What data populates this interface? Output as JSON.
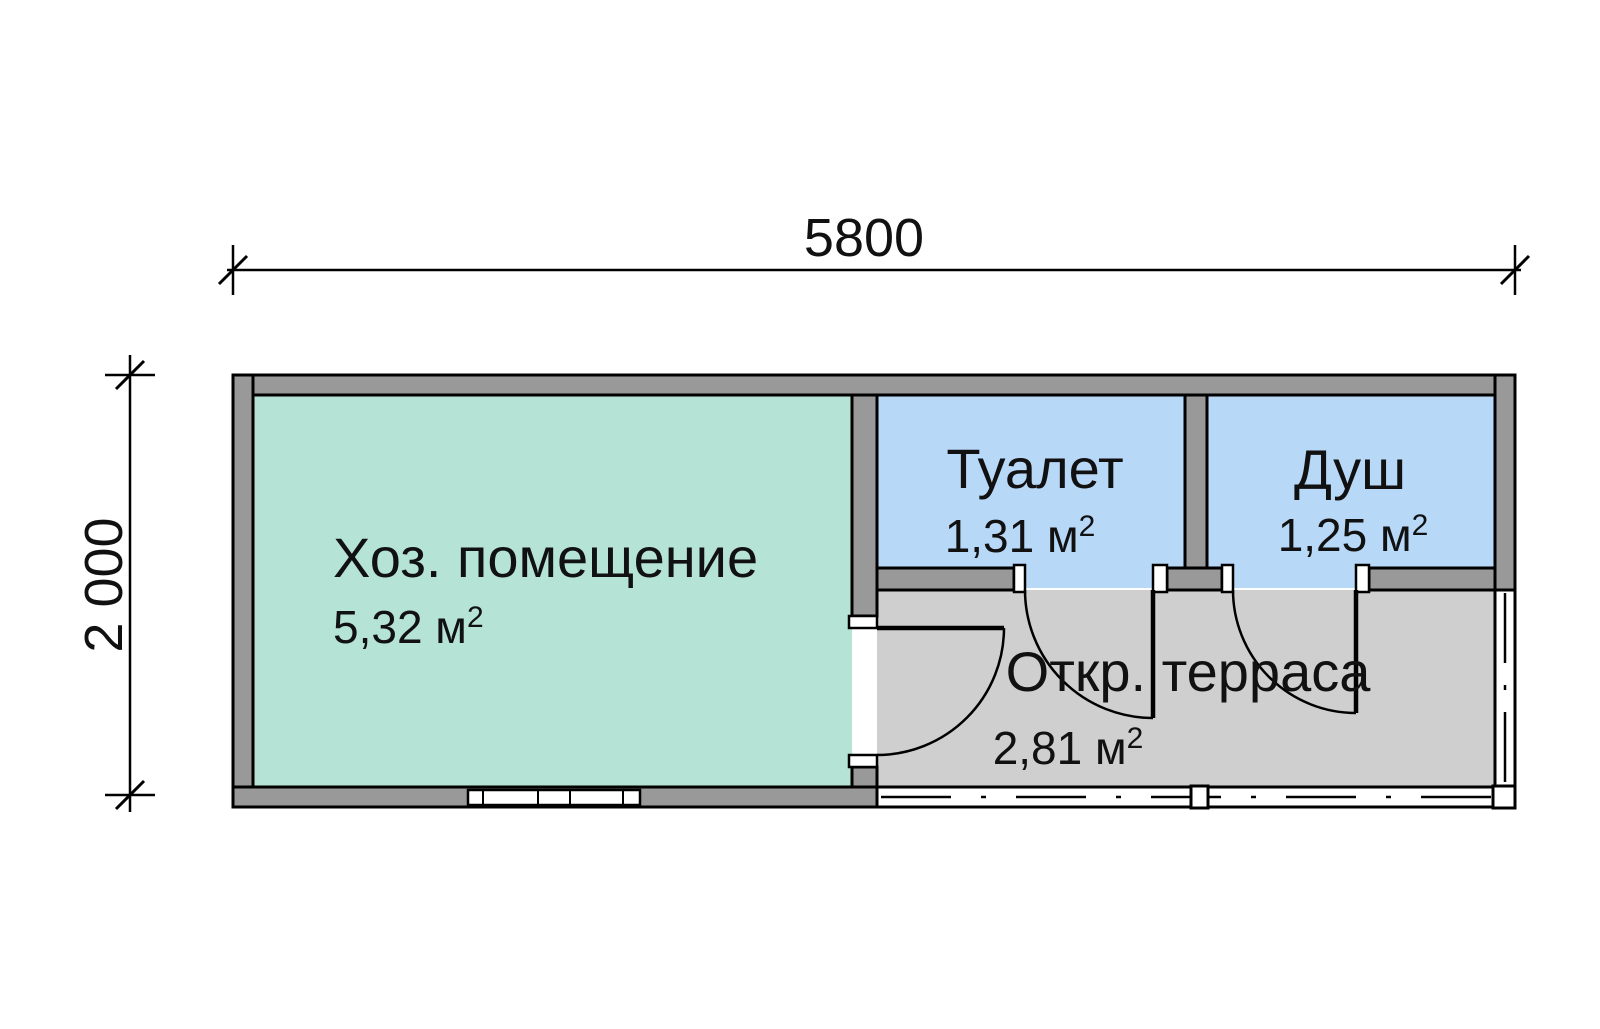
{
  "plan": {
    "dim_width": "5800",
    "dim_height": "2 000",
    "rooms": {
      "utility": {
        "name": "Хоз. помещение",
        "area": "5,32 м",
        "area_sup": "2",
        "fill": "#b5e3d6"
      },
      "toilet": {
        "name": "Туалет",
        "area": "1,31 м",
        "area_sup": "2",
        "fill": "#b8d8f8"
      },
      "shower": {
        "name": "Душ",
        "area": "1,25 м",
        "area_sup": "2",
        "fill": "#b8d8f8"
      },
      "terrace": {
        "name": "Откр. терраса",
        "area": "2,81 м",
        "area_sup": "2",
        "fill": "#cfcfcf"
      }
    },
    "colors": {
      "wall": "#999999",
      "outline": "#000000",
      "jamb": "#ffffff",
      "background": "#ffffff"
    }
  }
}
